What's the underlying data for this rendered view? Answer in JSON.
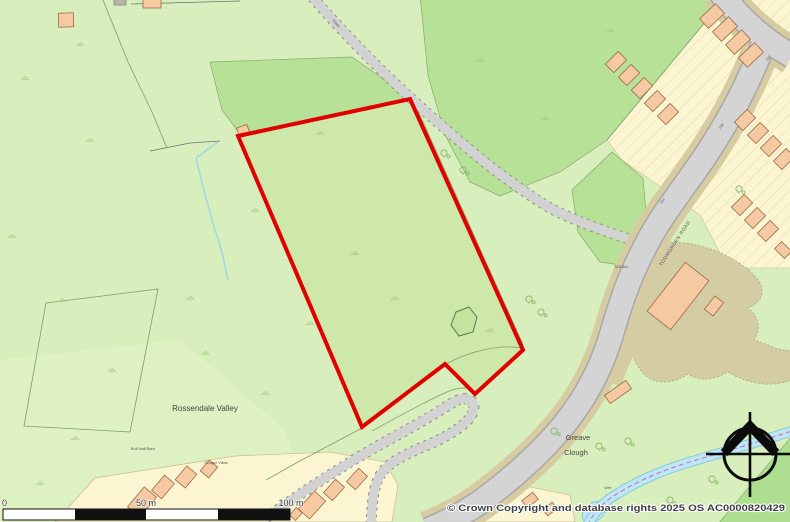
{
  "map": {
    "place_labels": {
      "valley": "Rossendale Valley",
      "clough_line1": "Greave",
      "clough_line2": "Clough",
      "barn": "Bull Hall Barn",
      "villas": "Chapel Villas",
      "road_name": "TODMORDEN ROAD",
      "track": "Track",
      "spot_height": "318.8m",
      "weir": "Weir",
      "house_number_1": "130",
      "house_number_2": "138",
      "house_number_3": "124"
    },
    "scale_bar": {
      "label_start": "0",
      "label_mid": "50 m",
      "label_end": "100 m"
    },
    "attribution": "© Crown Copyright and database rights 2025 OS AC0000820429",
    "legend_colors": {
      "site_boundary_red": "#e10000",
      "field_green": "#d8eebc",
      "site_field_green": "#cde8a9",
      "woodland_green": "#b7e197",
      "building_peach": "#f5caa2",
      "garden_yellow": "#fcf5d2",
      "road_grey": "#d4d4d4",
      "verge_tan": "#d6cba1",
      "water_blue": "#bde7f2"
    },
    "icons": {
      "compass_rose": "north-compass"
    }
  }
}
